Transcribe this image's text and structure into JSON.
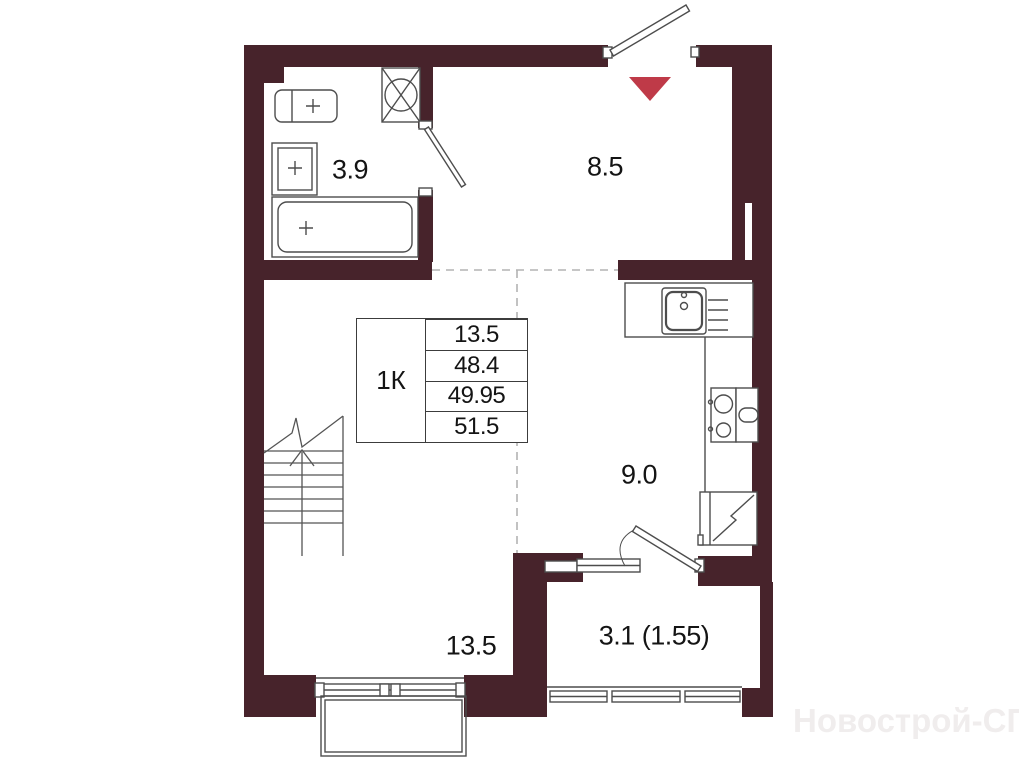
{
  "floor_plan": {
    "unit_table": {
      "unit_type": "1К",
      "rows": [
        "13.5",
        "48.4",
        "49.95",
        "51.5"
      ]
    },
    "room_areas": {
      "bathroom": "3.9",
      "hallway": "8.5",
      "kitchen": "9.0",
      "living_room": "13.5",
      "balcony": "3.1 (1.55)"
    },
    "watermark": "Новострой-СПб",
    "colors": {
      "wall": "#47232B",
      "entrance_marker": "#BF3A48",
      "fixture_line": "#4d4d4d",
      "zone_dash_line": "#b3b3b3"
    }
  }
}
